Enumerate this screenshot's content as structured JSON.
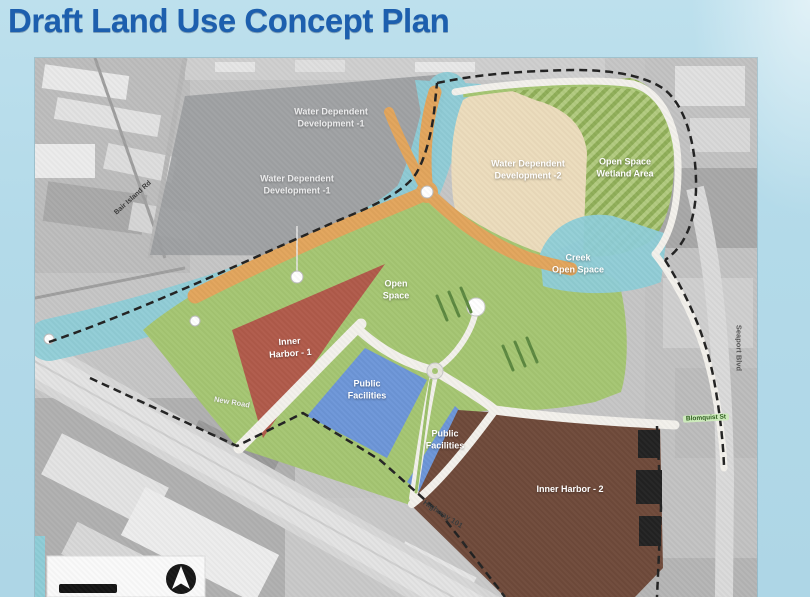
{
  "slide": {
    "title": "Draft Land Use Concept Plan"
  },
  "map": {
    "zone_labels": {
      "water_dependent_1": "Water Dependent\nDevelopment -1",
      "water_dependent_2": "Water Dependent\nDevelopment -2",
      "open_space_wetland": "Open Space\nWetland Area",
      "creek_open_space": "Creek\nOpen Space",
      "open_space": "Open\nSpace",
      "inner_harbor_1": "Inner\nHarbor - 1",
      "public_facilities": "Public\nFacilities",
      "inner_harbor_2": "Inner Harbor - 2"
    },
    "road_labels": {
      "bair_island_rd": "Bair Island Rd",
      "new_road": "New Road",
      "highway_101": "Highway 101",
      "seaport_blvd": "Seaport Blvd",
      "blomquist_st": "Blomquist St"
    },
    "colors": {
      "title_blue": "#1d5fae",
      "slide_bg": "#b7dcea",
      "water_dependent_gray": "#9b9da0",
      "creek_teal": "#8ecdd7",
      "water_dependent_beige": "#ecdcbc",
      "wetland_green": "#b2cb80",
      "wetland_stripe": "#8fae58",
      "open_space_green": "#a5c672",
      "promenade_orange": "#e2a55c",
      "inner_harbor_1_red": "#b05a4a",
      "public_facilities_blue": "#6d96d8",
      "inner_harbor_2_brown": "#6f4a3a",
      "road_white": "#f3f1ec",
      "boundary_black": "#222222"
    }
  }
}
